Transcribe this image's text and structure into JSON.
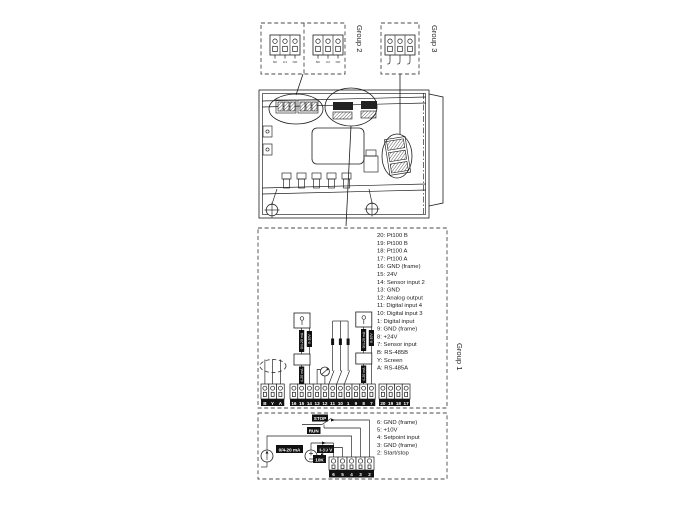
{
  "groups": {
    "group1": "Group 1",
    "group2": "Group 2",
    "group3": "Group 3"
  },
  "group2_connectors": {
    "relay1_pins": [
      "NC",
      "C1",
      "NO"
    ],
    "relay2_pins": [
      "NC",
      "C2",
      "NO"
    ]
  },
  "group1_terminals": {
    "descriptions": [
      "20: Pt100 B",
      "19: Pt100 B",
      "18: Pt100 A",
      "17: Pt100 A",
      "16: GND (frame)",
      "15: 24V",
      "14: Sensor input 2",
      "13: GND",
      "12: Analog output",
      "11: Digital input 4",
      "10: Digital input 3",
      "1: Digital input",
      "9: GND (frame)",
      "8: +24V",
      "7: Sensor input",
      "B: RS-485B",
      "Y: Screen",
      "A: RS-485A"
    ],
    "strip": [
      "16",
      "15",
      "14",
      "13",
      "12",
      "11",
      "10",
      "1",
      "9",
      "8",
      "7"
    ],
    "pt100_strip": [
      "20",
      "19",
      "18",
      "17"
    ],
    "bus_strip": [
      "B",
      "Y",
      "A"
    ],
    "sensor_labels": {
      "range_a": "0/4-20 mA",
      "range_b": "0-10V",
      "output": "4-20 mA"
    }
  },
  "setpoint_section": {
    "descriptions": [
      "6: GND (frame)",
      "5: +10V",
      "4: Setpoint input",
      "3: GND (frame)",
      "2: Start/stop"
    ],
    "strip": [
      "6",
      "5",
      "4",
      "3",
      "2"
    ],
    "stop": "STOP",
    "run": "RUN",
    "potentiometer": "10K",
    "current_signal": "0/4-20 mA",
    "voltage_signal": "0-10 V"
  }
}
